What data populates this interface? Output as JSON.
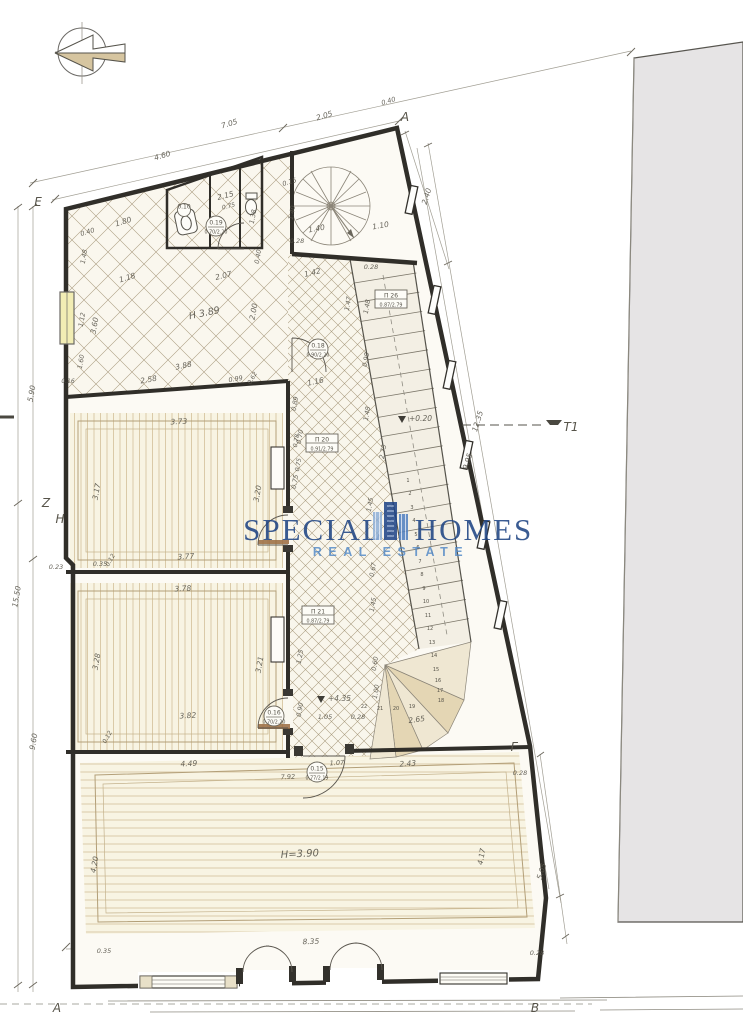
{
  "watermark": {
    "word1": "SPECIAL",
    "word2": "HOMES",
    "tagline": "REAL ESTATE",
    "title_color": "#1d4383",
    "tagline_color": "#4d86c6"
  },
  "colors": {
    "wall": "#302e29",
    "paper": "#ffffff",
    "room_fill": "#f8f4e3",
    "neighbor_fill": "#e6e4e5",
    "window_yellow": "#f2edb4"
  },
  "room_labels": {
    "hall_height": "H 3.89",
    "living_height": "H=3.90"
  },
  "levels": [
    {
      "label": "+0.20",
      "x": 412,
      "y": 421
    },
    {
      "label": "+4.35",
      "x": 331,
      "y": 701
    }
  ],
  "markers": [
    {
      "label": "A",
      "x": 405,
      "y": 121
    },
    {
      "label": "E",
      "x": 38,
      "y": 206
    },
    {
      "label": "Z",
      "x": 46,
      "y": 507
    },
    {
      "label": "H",
      "x": 60,
      "y": 523
    },
    {
      "label": "Г",
      "x": 514,
      "y": 751
    },
    {
      "label": "T1",
      "x": 571,
      "y": 431
    },
    {
      "label": "A",
      "x": 57,
      "y": 1012
    },
    {
      "label": "B",
      "x": 535,
      "y": 1012
    }
  ],
  "tags": [
    {
      "shape": "circle",
      "line1": "0.19",
      "line2": "0.70/2.20",
      "x": 216,
      "y": 226
    },
    {
      "shape": "circle",
      "line1": "0.10",
      "line2": "",
      "x": 184,
      "y": 210
    },
    {
      "shape": "circle",
      "line1": "0.18",
      "line2": "0.90/2.20",
      "x": 318,
      "y": 349
    },
    {
      "shape": "circle",
      "line1": "0.16",
      "line2": "0.70/2.20",
      "x": 274,
      "y": 716
    },
    {
      "shape": "circle",
      "line1": "0.15",
      "line2": "0.77/2.19",
      "x": 317,
      "y": 772
    },
    {
      "shape": "box",
      "line1": "П 26",
      "line2": "0.87/2.79",
      "x": 391,
      "y": 299
    },
    {
      "shape": "box",
      "line1": "П 20",
      "line2": "0.91/2.79",
      "x": 322,
      "y": 443
    },
    {
      "shape": "box",
      "line1": "П 21",
      "line2": "0.87/2.79",
      "x": 318,
      "y": 615
    }
  ],
  "stair_steps": [
    {
      "n": "1",
      "x": 408,
      "y": 482
    },
    {
      "n": "2",
      "x": 410,
      "y": 495
    },
    {
      "n": "3",
      "x": 412,
      "y": 509
    },
    {
      "n": "4",
      "x": 414,
      "y": 522
    },
    {
      "n": "5",
      "x": 416,
      "y": 536
    },
    {
      "n": "6",
      "x": 418,
      "y": 549
    },
    {
      "n": "7",
      "x": 420,
      "y": 563
    },
    {
      "n": "8",
      "x": 422,
      "y": 576
    },
    {
      "n": "9",
      "x": 424,
      "y": 590
    },
    {
      "n": "10",
      "x": 426,
      "y": 603
    },
    {
      "n": "11",
      "x": 428,
      "y": 617
    },
    {
      "n": "12",
      "x": 430,
      "y": 630
    },
    {
      "n": "13",
      "x": 432,
      "y": 644
    },
    {
      "n": "14",
      "x": 434,
      "y": 657
    },
    {
      "n": "15",
      "x": 436,
      "y": 671
    },
    {
      "n": "16",
      "x": 438,
      "y": 682
    },
    {
      "n": "17",
      "x": 440,
      "y": 692
    },
    {
      "n": "18",
      "x": 441,
      "y": 702
    },
    {
      "n": "19",
      "x": 412,
      "y": 708
    },
    {
      "n": "20",
      "x": 396,
      "y": 710
    },
    {
      "n": "21",
      "x": 380,
      "y": 710
    },
    {
      "n": "22",
      "x": 364,
      "y": 708
    }
  ],
  "dimension_labels": [
    {
      "t": "4.60",
      "x": 163,
      "y": 158,
      "r": -17
    },
    {
      "t": "7.05",
      "x": 230,
      "y": 126,
      "r": -17
    },
    {
      "t": "2.05",
      "x": 325,
      "y": 118,
      "r": -17
    },
    {
      "t": "0.40",
      "x": 389,
      "y": 103,
      "r": -17,
      "s": 6.5
    },
    {
      "t": "2.40",
      "x": 429,
      "y": 197,
      "r": -73
    },
    {
      "t": "0.15",
      "x": 290,
      "y": 184,
      "r": -17,
      "s": 6.5
    },
    {
      "t": "1.40",
      "x": 294,
      "y": 213,
      "r": -80,
      "s": 6.5
    },
    {
      "t": "1.40",
      "x": 317,
      "y": 231,
      "r": -10
    },
    {
      "t": "1.10",
      "x": 381,
      "y": 228,
      "r": -10
    },
    {
      "t": "0.28",
      "x": 297,
      "y": 243,
      "s": 6.5
    },
    {
      "t": "0.40",
      "x": 88,
      "y": 234,
      "r": -17,
      "s": 6.5
    },
    {
      "t": "1.80",
      "x": 124,
      "y": 224,
      "r": -17
    },
    {
      "t": "2.15",
      "x": 226,
      "y": 198,
      "r": -14
    },
    {
      "t": "0.75",
      "x": 229,
      "y": 208,
      "r": -14,
      "s": 6
    },
    {
      "t": "1.38",
      "x": 255,
      "y": 217,
      "r": -80,
      "s": 6.5
    },
    {
      "t": "1.48",
      "x": 86,
      "y": 257,
      "r": -80,
      "s": 6.5
    },
    {
      "t": "1.12",
      "x": 84,
      "y": 320,
      "r": -80,
      "s": 6.5
    },
    {
      "t": "3.60",
      "x": 97,
      "y": 326,
      "r": -80
    },
    {
      "t": "1.60",
      "x": 83,
      "y": 362,
      "r": -80,
      "s": 6.5
    },
    {
      "t": "1.18",
      "x": 128,
      "y": 280,
      "r": -17
    },
    {
      "t": "2.07",
      "x": 224,
      "y": 278,
      "r": -14
    },
    {
      "t": "1.42",
      "x": 313,
      "y": 275,
      "r": -14
    },
    {
      "t": "0.28",
      "x": 371,
      "y": 269,
      "s": 6.5
    },
    {
      "t": "H 3.89",
      "x": 205,
      "y": 316,
      "r": -12,
      "s": 9.5
    },
    {
      "t": "2.00",
      "x": 256,
      "y": 312,
      "r": -80
    },
    {
      "t": "1.47",
      "x": 350,
      "y": 304,
      "r": -80,
      "s": 6.5
    },
    {
      "t": "0.40",
      "x": 260,
      "y": 257,
      "r": -80,
      "s": 6.5
    },
    {
      "t": "3.88",
      "x": 184,
      "y": 368,
      "r": -12
    },
    {
      "t": "2.58",
      "x": 149,
      "y": 382,
      "r": -10
    },
    {
      "t": "0.99",
      "x": 236,
      "y": 381,
      "r": -10,
      "s": 6.5
    },
    {
      "t": "0.62",
      "x": 254,
      "y": 379,
      "r": -60,
      "s": 6
    },
    {
      "t": "0.16",
      "x": 68,
      "y": 383,
      "s": 6
    },
    {
      "t": "1.16",
      "x": 316,
      "y": 384,
      "r": -12
    },
    {
      "t": "0.89",
      "x": 297,
      "y": 404,
      "r": -80,
      "s": 6.5
    },
    {
      "t": "1.48",
      "x": 369,
      "y": 307,
      "r": -80,
      "s": 6.5
    },
    {
      "t": "0.98",
      "x": 368,
      "y": 360,
      "r": -80,
      "s": 6.5
    },
    {
      "t": "1.48",
      "x": 369,
      "y": 414,
      "r": -80,
      "s": 6.5
    },
    {
      "t": "12.35",
      "x": 480,
      "y": 422,
      "r": -73
    },
    {
      "t": "9.95",
      "x": 470,
      "y": 462,
      "r": -73
    },
    {
      "t": "2.73",
      "x": 385,
      "y": 452,
      "r": -80,
      "s": 6.5
    },
    {
      "t": "0.70",
      "x": 302,
      "y": 437,
      "r": -80,
      "s": 6.5
    },
    {
      "t": "0.75",
      "x": 297,
      "y": 482,
      "r": -80,
      "s": 6.5
    },
    {
      "t": "1.45",
      "x": 372,
      "y": 505,
      "r": -80,
      "s": 6.5
    },
    {
      "t": "0.67",
      "x": 375,
      "y": 570,
      "r": -80,
      "s": 6.5
    },
    {
      "t": "1.45",
      "x": 375,
      "y": 605,
      "r": -80,
      "s": 6.5
    },
    {
      "t": "3.73",
      "x": 179,
      "y": 424,
      "r": -3
    },
    {
      "t": "3.17",
      "x": 99,
      "y": 492,
      "r": -80
    },
    {
      "t": "3.20",
      "x": 260,
      "y": 494,
      "r": -80
    },
    {
      "t": "3.77",
      "x": 186,
      "y": 559,
      "r": -3
    },
    {
      "t": "0.35",
      "x": 100,
      "y": 566,
      "s": 6.5
    },
    {
      "t": "0.12",
      "x": 112,
      "y": 561,
      "r": -60,
      "s": 6
    },
    {
      "t": "0.78",
      "x": 298,
      "y": 441,
      "r": -80,
      "s": 6
    },
    {
      "t": "0.75",
      "x": 300,
      "y": 465,
      "r": -80,
      "s": 6
    },
    {
      "t": "3.78",
      "x": 183,
      "y": 591,
      "r": -3
    },
    {
      "t": "3.28",
      "x": 99,
      "y": 662,
      "r": -80
    },
    {
      "t": "3.21",
      "x": 262,
      "y": 665,
      "r": -80
    },
    {
      "t": "3.82",
      "x": 188,
      "y": 718,
      "r": -3
    },
    {
      "t": "0.12",
      "x": 109,
      "y": 738,
      "r": -60,
      "s": 6
    },
    {
      "t": "1.25",
      "x": 302,
      "y": 657,
      "r": -80,
      "s": 6.5
    },
    {
      "t": "0.60",
      "x": 377,
      "y": 664,
      "r": -80,
      "s": 6.5
    },
    {
      "t": "1.00",
      "x": 378,
      "y": 692,
      "r": -80,
      "s": 6.5
    },
    {
      "t": "0.90",
      "x": 302,
      "y": 710,
      "r": -80,
      "s": 6.5
    },
    {
      "t": "1.05",
      "x": 325,
      "y": 719,
      "s": 6.5
    },
    {
      "t": "0.28",
      "x": 358,
      "y": 719,
      "s": 6.5
    },
    {
      "t": "2.65",
      "x": 417,
      "y": 722,
      "r": -8
    },
    {
      "t": "4.49",
      "x": 189,
      "y": 766,
      "r": -3
    },
    {
      "t": "7.92",
      "x": 288,
      "y": 779,
      "r": -3,
      "s": 6.5
    },
    {
      "t": "1.07",
      "x": 337,
      "y": 765,
      "r": -3,
      "s": 6.5
    },
    {
      "t": "2.43",
      "x": 408,
      "y": 766,
      "r": -4
    },
    {
      "t": "0.28",
      "x": 520,
      "y": 775,
      "s": 6.5
    },
    {
      "t": "H=3.90",
      "x": 300,
      "y": 857,
      "r": -3,
      "s": 10
    },
    {
      "t": "4.20",
      "x": 97,
      "y": 865,
      "r": -80
    },
    {
      "t": "4.17",
      "x": 484,
      "y": 857,
      "r": -80
    },
    {
      "t": "8.35",
      "x": 311,
      "y": 944,
      "r": -2
    },
    {
      "t": "0.35",
      "x": 104,
      "y": 953,
      "s": 6.5
    },
    {
      "t": "0.28",
      "x": 537,
      "y": 955,
      "s": 6.5
    },
    {
      "t": "5.05",
      "x": 544,
      "y": 872,
      "r": -73
    },
    {
      "t": "5.90",
      "x": 34,
      "y": 394,
      "r": -80
    },
    {
      "t": "15.50",
      "x": 19,
      "y": 597,
      "r": -80
    },
    {
      "t": "9.60",
      "x": 36,
      "y": 742,
      "r": -80
    },
    {
      "t": "0.23",
      "x": 56,
      "y": 569,
      "s": 6.5
    }
  ]
}
